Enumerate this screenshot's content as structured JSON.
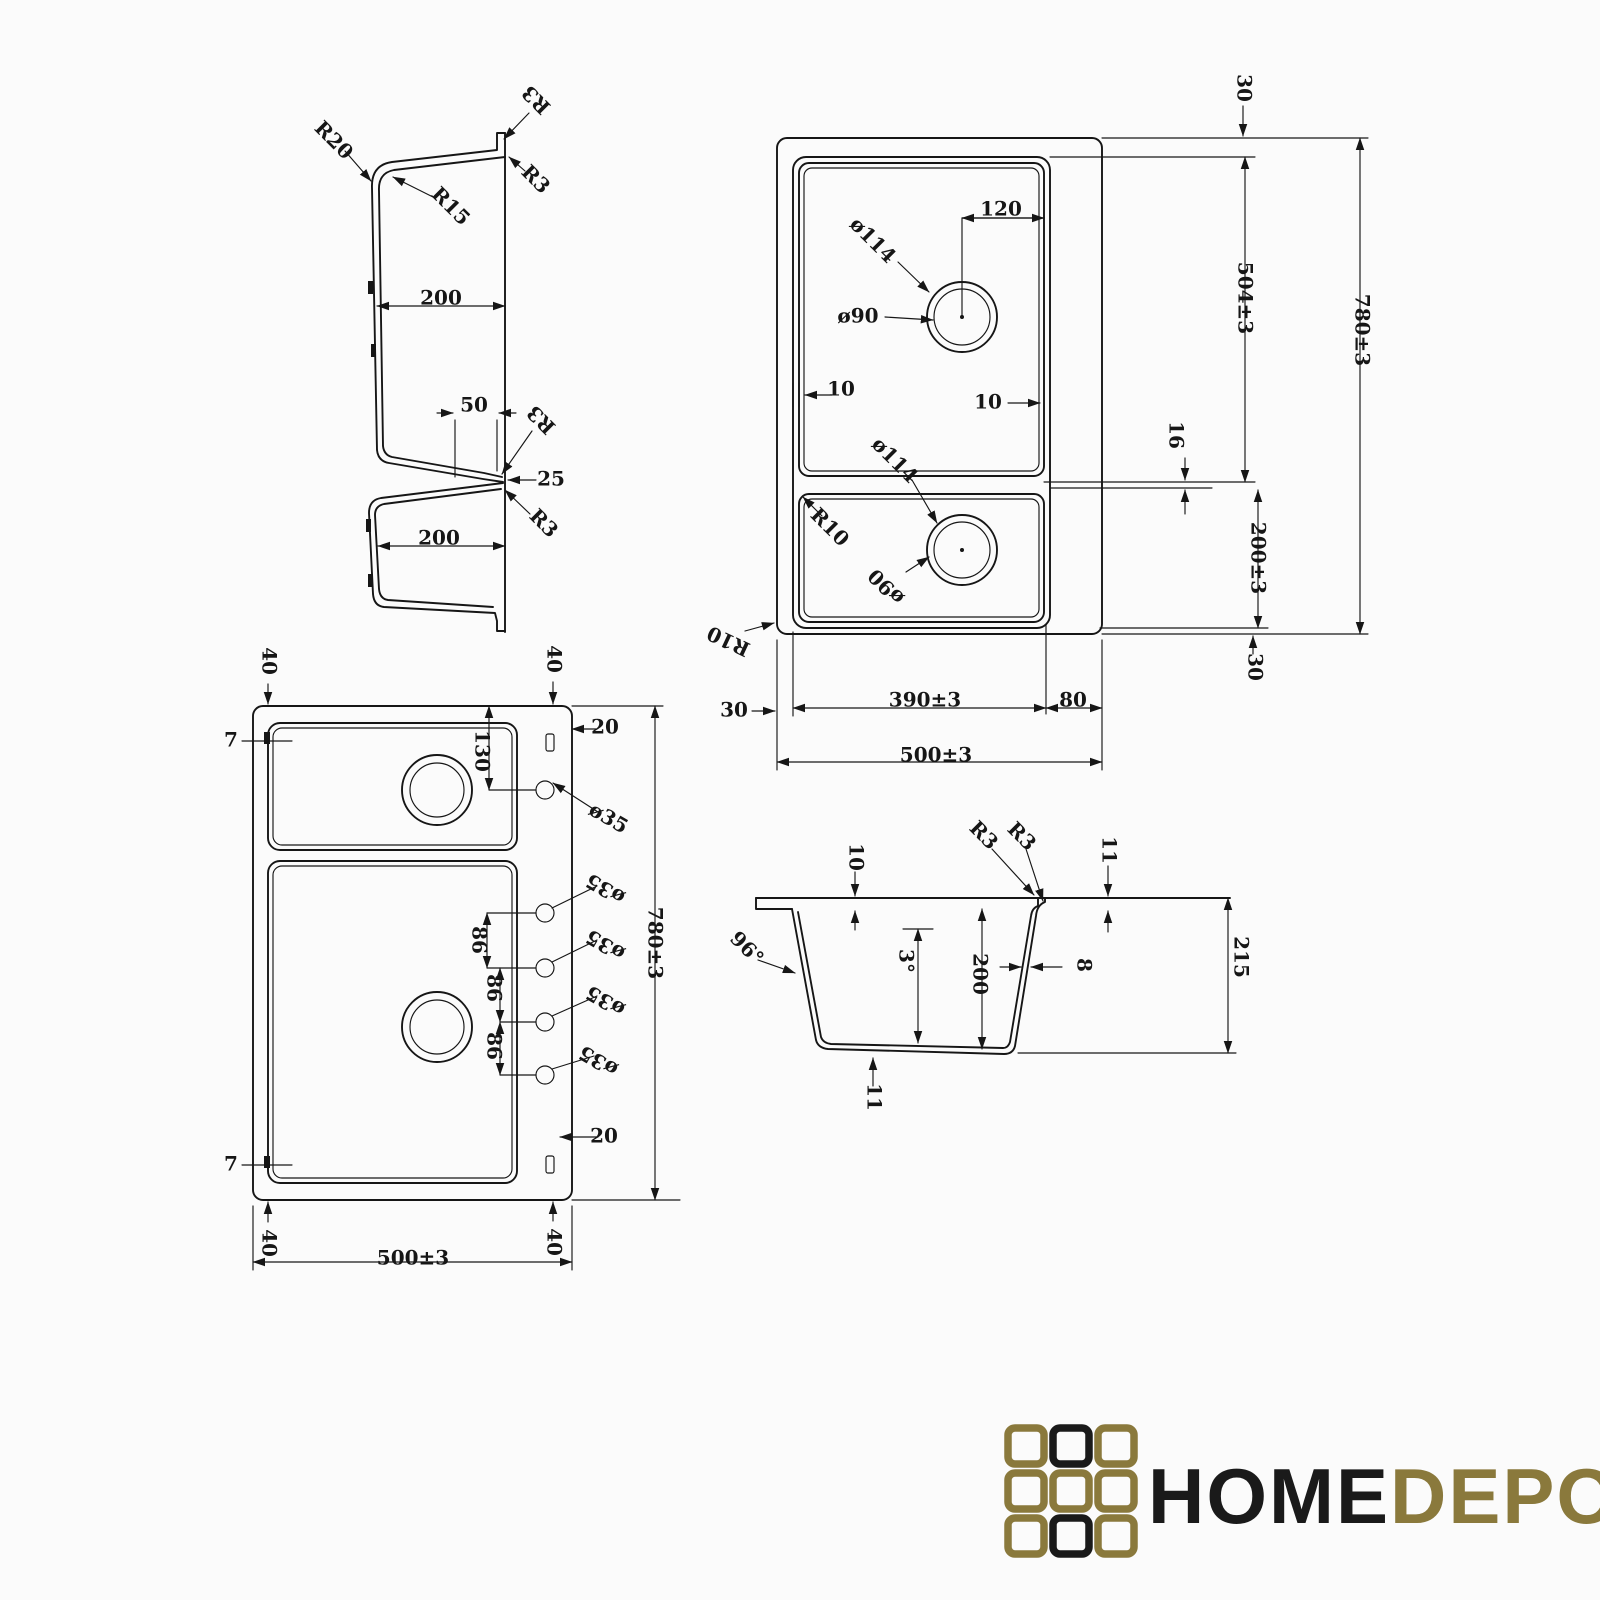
{
  "colors": {
    "background": "#fbfbfb",
    "ink": "#161616"
  },
  "views": {
    "profile_section": {
      "name": "double-bowl side profile section",
      "labels": [
        {
          "t": "R20",
          "x": 333,
          "y": 141,
          "r": 45
        },
        {
          "t": "R15",
          "x": 450,
          "y": 207,
          "r": 45
        },
        {
          "t": "R3",
          "x": 537,
          "y": 99,
          "r": 225
        },
        {
          "t": "R3",
          "x": 535,
          "y": 180,
          "r": 45
        },
        {
          "t": "200",
          "x": 441,
          "y": 299,
          "r": 0
        },
        {
          "t": "50",
          "x": 474,
          "y": 406,
          "r": 0
        },
        {
          "t": "R3",
          "x": 542,
          "y": 419,
          "r": 225
        },
        {
          "t": "25",
          "x": 551,
          "y": 480,
          "r": 0
        },
        {
          "t": "R3",
          "x": 543,
          "y": 524,
          "r": 45
        },
        {
          "t": "200",
          "x": 439,
          "y": 539,
          "r": 0
        }
      ]
    },
    "plan_top": {
      "name": "plan view with drain holes",
      "labels": [
        {
          "t": "30",
          "x": 1243,
          "y": 88,
          "r": 90
        },
        {
          "t": "120",
          "x": 1001,
          "y": 210,
          "r": 0
        },
        {
          "t": "ø114",
          "x": 872,
          "y": 241,
          "r": 45
        },
        {
          "t": "ø90",
          "x": 858,
          "y": 317,
          "r": 0
        },
        {
          "t": "10",
          "x": 841,
          "y": 390,
          "r": 0
        },
        {
          "t": "10",
          "x": 988,
          "y": 403,
          "r": 0
        },
        {
          "t": "ø114",
          "x": 894,
          "y": 461,
          "r": 45
        },
        {
          "t": "R10",
          "x": 829,
          "y": 528,
          "r": 45
        },
        {
          "t": "ø90",
          "x": 887,
          "y": 586,
          "r": 225
        },
        {
          "t": "R10",
          "x": 729,
          "y": 640,
          "r": 205
        },
        {
          "t": "504±3",
          "x": 1244,
          "y": 298,
          "r": 90,
          "fs": 22
        },
        {
          "t": "16",
          "x": 1175,
          "y": 435,
          "r": 90
        },
        {
          "t": "200±3",
          "x": 1257,
          "y": 558,
          "r": 90,
          "fs": 22
        },
        {
          "t": "780±3",
          "x": 1361,
          "y": 330,
          "r": 90,
          "fs": 22
        },
        {
          "t": "30",
          "x": 1254,
          "y": 667,
          "r": 90
        },
        {
          "t": "30",
          "x": 734,
          "y": 711,
          "r": 0
        },
        {
          "t": "390±3",
          "x": 925,
          "y": 701,
          "r": 0,
          "fs": 22
        },
        {
          "t": "80",
          "x": 1073,
          "y": 701,
          "r": 0
        },
        {
          "t": "500±3",
          "x": 936,
          "y": 756,
          "r": 0,
          "fs": 22
        }
      ]
    },
    "plan_holes": {
      "name": "plan view with faucet holes",
      "labels": [
        {
          "t": "40",
          "x": 268,
          "y": 661,
          "r": 90
        },
        {
          "t": "40",
          "x": 553,
          "y": 659,
          "r": 90
        },
        {
          "t": "7",
          "x": 231,
          "y": 741,
          "r": 0
        },
        {
          "t": "130",
          "x": 481,
          "y": 751,
          "r": 90
        },
        {
          "t": "20",
          "x": 605,
          "y": 728,
          "r": 0
        },
        {
          "t": "ø35",
          "x": 608,
          "y": 819,
          "r": 30
        },
        {
          "t": "ø35",
          "x": 606,
          "y": 888,
          "r": 210
        },
        {
          "t": "ø35",
          "x": 606,
          "y": 944,
          "r": 210
        },
        {
          "t": "ø35",
          "x": 606,
          "y": 1000,
          "r": 210
        },
        {
          "t": "ø35",
          "x": 599,
          "y": 1060,
          "r": 210
        },
        {
          "t": "86",
          "x": 478,
          "y": 940,
          "r": 90
        },
        {
          "t": "86",
          "x": 493,
          "y": 988,
          "r": 90
        },
        {
          "t": "86",
          "x": 493,
          "y": 1046,
          "r": 90
        },
        {
          "t": "780±3",
          "x": 654,
          "y": 943,
          "r": 90,
          "fs": 22
        },
        {
          "t": "20",
          "x": 604,
          "y": 1137,
          "r": 0
        },
        {
          "t": "7",
          "x": 231,
          "y": 1165,
          "r": 0
        },
        {
          "t": "40",
          "x": 268,
          "y": 1243,
          "r": 90
        },
        {
          "t": "40",
          "x": 553,
          "y": 1242,
          "r": 90
        },
        {
          "t": "500±3",
          "x": 413,
          "y": 1259,
          "r": 0,
          "fs": 22
        }
      ]
    },
    "cross_section": {
      "name": "bowl cross section",
      "labels": [
        {
          "t": "10",
          "x": 855,
          "y": 857,
          "r": 90
        },
        {
          "t": "R3",
          "x": 983,
          "y": 836,
          "r": 45
        },
        {
          "t": "R3",
          "x": 1021,
          "y": 837,
          "r": 45
        },
        {
          "t": "11",
          "x": 1108,
          "y": 850,
          "r": 90
        },
        {
          "t": "96°",
          "x": 746,
          "y": 949,
          "r": 45
        },
        {
          "t": "3°",
          "x": 905,
          "y": 961,
          "r": 90
        },
        {
          "t": "200",
          "x": 979,
          "y": 974,
          "r": 90
        },
        {
          "t": "8",
          "x": 1083,
          "y": 965,
          "r": 90
        },
        {
          "t": "215",
          "x": 1240,
          "y": 957,
          "r": 90
        },
        {
          "t": "11",
          "x": 873,
          "y": 1097,
          "r": 90
        }
      ]
    }
  },
  "logo": {
    "home": "HOME",
    "depo": "DEPO",
    "gold": "#8a793c",
    "black": "#1a1a1a",
    "grid": [
      "gold",
      "black",
      "gold",
      "gold",
      "gold",
      "gold",
      "gold",
      "black",
      "gold"
    ]
  }
}
